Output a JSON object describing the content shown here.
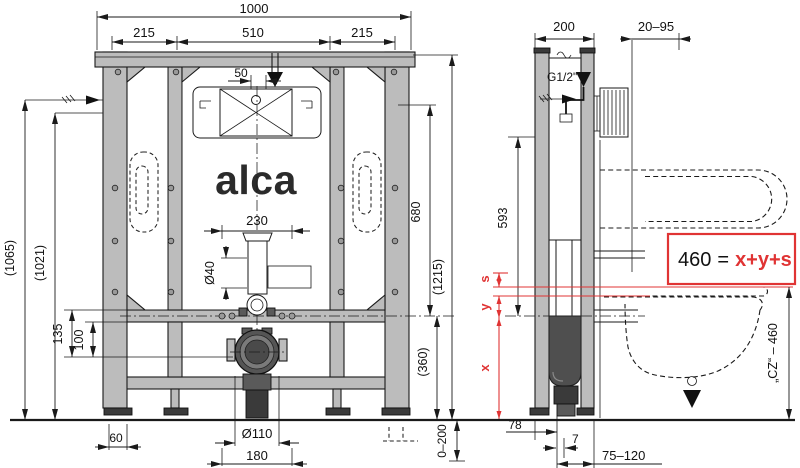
{
  "brand": "alca",
  "front": {
    "dims": {
      "total_width": "1000",
      "span_left": "215",
      "span_center": "510",
      "span_right": "215",
      "inlet_offset": "50",
      "flush_width": "230",
      "flush_dia": "Ø40",
      "height_outer": "(1065)",
      "height_inner": "(1021)",
      "dim_135": "135",
      "dim_100": "100",
      "foot_offset": "60",
      "drain_dia": "Ø110",
      "drain_span": "180",
      "dim_680": "680",
      "frame_height": "(1215)",
      "drain_height": "(360)",
      "leg_adjust": "0–200"
    }
  },
  "side": {
    "dims": {
      "frame_depth": "200",
      "wall_range": "20–95",
      "inlet_thread": "G1/2\"",
      "dim_593": "593",
      "dim_78": "78",
      "dim_7": "7",
      "outlet_range": "75–120",
      "bowl_height": "„CZ“ – 460"
    },
    "formula": {
      "lhs": "460",
      "eq": "=",
      "rhs": "x+y+s"
    },
    "vars": {
      "s": "s",
      "y": "y",
      "x": "x"
    }
  },
  "colors": {
    "accent_red": "#e03434",
    "frame_gray": "#bcbcbc",
    "dark_gray": "#3a3a3a"
  }
}
